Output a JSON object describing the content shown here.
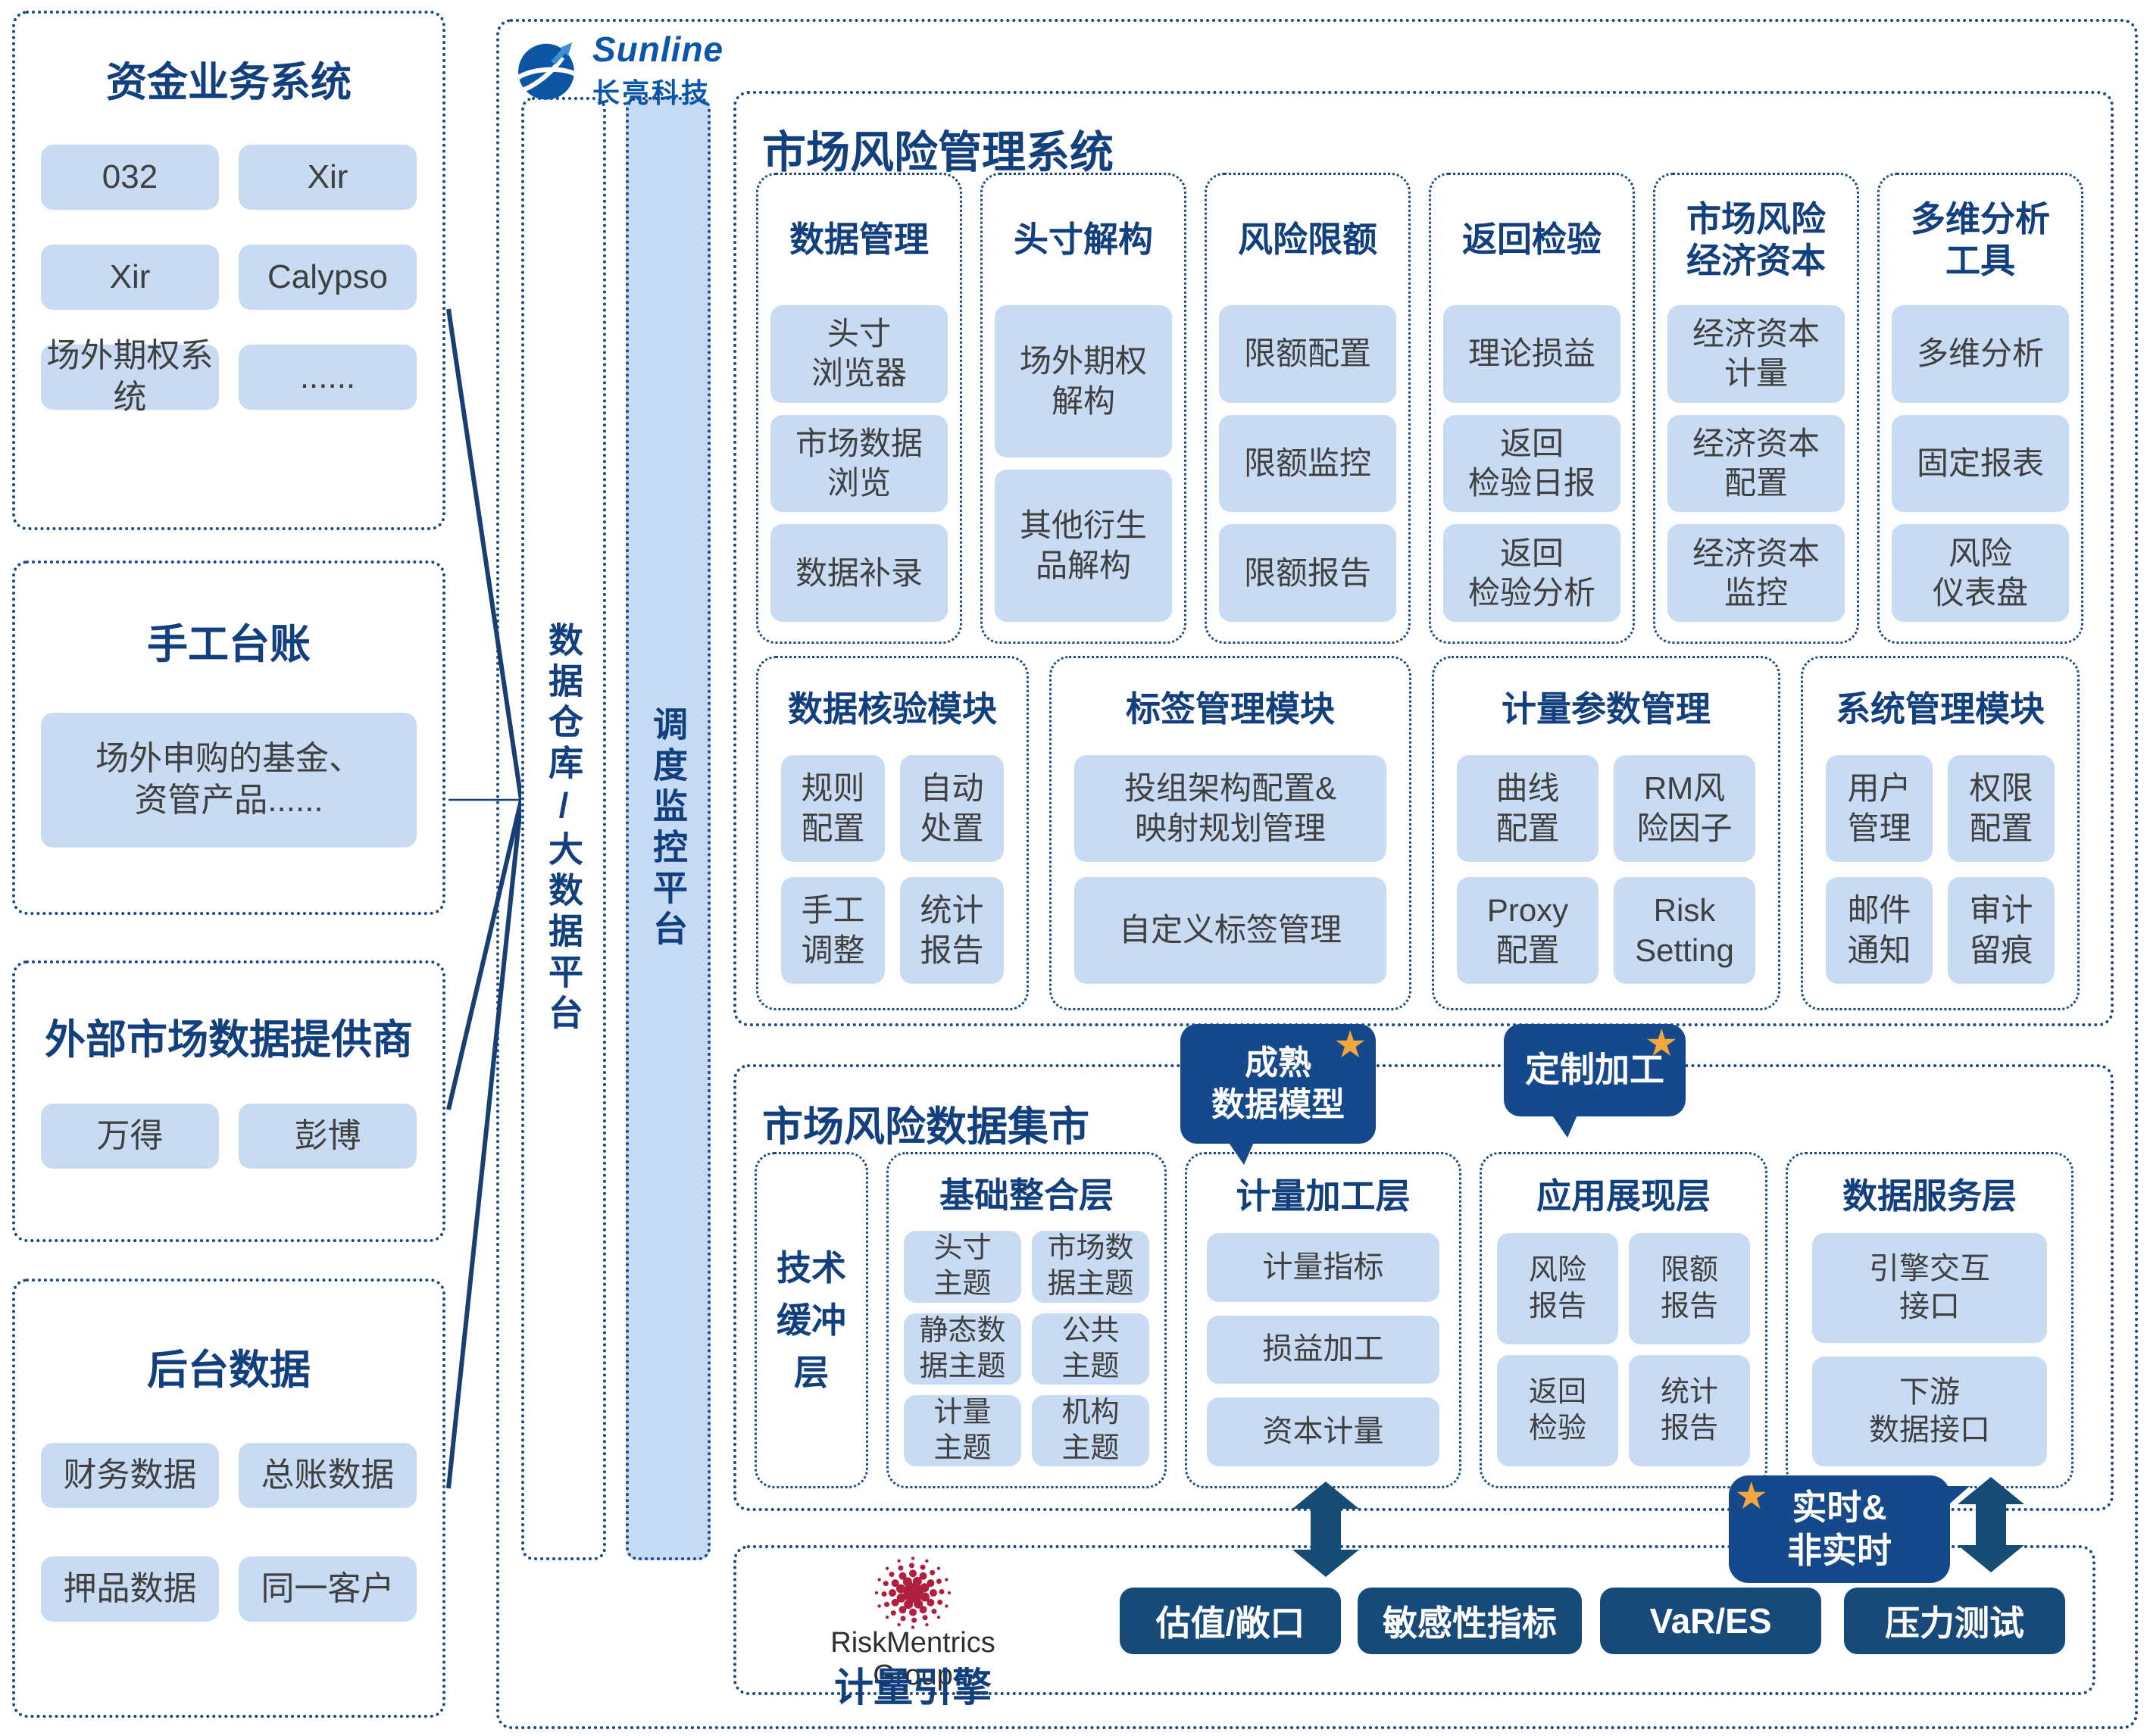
{
  "brand": {
    "name_en": "Sunline",
    "name_cn": "长亮科技"
  },
  "sources": [
    {
      "title": "资金业务系统",
      "items": [
        "032",
        "Xir",
        "Xir",
        "Calypso",
        "场外期权系统",
        "......"
      ]
    },
    {
      "title": "手工台账",
      "items": [
        "场外申购的基金、\n资管产品......"
      ]
    },
    {
      "title": "外部市场数据提供商",
      "items": [
        "万得",
        "彭博"
      ]
    },
    {
      "title": "后台数据",
      "items": [
        "财务数据",
        "总账数据",
        "押品数据",
        "同一客户"
      ]
    }
  ],
  "platform": {
    "warehouse_bar": "数据仓库/大数据平台",
    "schedule_bar": "调度监控平台"
  },
  "risk_system": {
    "title": "市场风险管理系统",
    "columns": [
      {
        "title": "数据管理",
        "items": [
          "头寸\n浏览器",
          "市场数据\n浏览",
          "数据补录"
        ]
      },
      {
        "title": "头寸解构",
        "items": [
          "场外期权\n解构",
          "其他衍生\n品解构"
        ]
      },
      {
        "title": "风险限额",
        "items": [
          "限额配置",
          "限额监控",
          "限额报告"
        ]
      },
      {
        "title": "返回检验",
        "items": [
          "理论损益",
          "返回\n检验日报",
          "返回\n检验分析"
        ]
      },
      {
        "title": "市场风险\n经济资本",
        "items": [
          "经济资本\n计量",
          "经济资本\n配置",
          "经济资本\n监控"
        ]
      },
      {
        "title": "多维分析\n工具",
        "items": [
          "多维分析",
          "固定报表",
          "风险\n仪表盘"
        ]
      }
    ],
    "modules": [
      {
        "title": "数据核验模块",
        "items": [
          "规则\n配置",
          "自动\n处置",
          "手工\n调整",
          "统计\n报告"
        ]
      },
      {
        "title": "标签管理模块",
        "items": [
          "投组架构配置&\n映射规划管理",
          "自定义标签管理"
        ]
      },
      {
        "title": "计量参数管理",
        "items": [
          "曲线\n配置",
          "RM风\n险因子",
          "Proxy\n配置",
          "Risk\nSetting"
        ]
      },
      {
        "title": "系统管理模块",
        "items": [
          "用户\n管理",
          "权限\n配置",
          "邮件\n通知",
          "审计\n留痕"
        ]
      }
    ]
  },
  "data_mart": {
    "title": "市场风险数据集市",
    "badge_mature": "成熟\n数据模型",
    "badge_custom": "定制加工",
    "buffer_layer": "技术\n缓冲\n层",
    "layers": [
      {
        "title": "基础整合层",
        "items": [
          "头寸\n主题",
          "市场数\n据主题",
          "静态数\n据主题",
          "公共\n主题",
          "计量\n主题",
          "机构\n主题"
        ]
      },
      {
        "title": "计量加工层",
        "items": [
          "计量指标",
          "损益加工",
          "资本计量"
        ]
      },
      {
        "title": "应用展现层",
        "items": [
          "风险\n报告",
          "限额\n报告",
          "返回\n检验",
          "统计\n报告"
        ]
      },
      {
        "title": "数据服务层",
        "items": [
          "引擎交互\n接口",
          "下游\n数据接口"
        ]
      }
    ]
  },
  "realtime_badge": "实时&\n非实时",
  "engine": {
    "group": "RiskMentrics Group",
    "title": "计量引擎",
    "buttons": [
      "估值/敞口",
      "敏感性指标",
      "VaR/ES",
      "压力测试"
    ]
  }
}
